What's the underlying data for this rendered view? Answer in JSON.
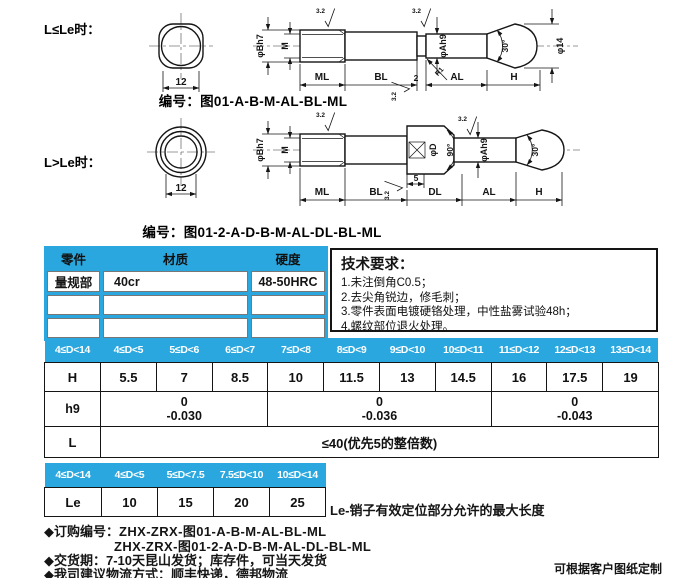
{
  "theme": {
    "accent": "#2aa7de",
    "ink": "#151515"
  },
  "drawing1": {
    "condition": "L≤Le时：",
    "code_label": "编号：图01-A-B-M-AL-BL-ML",
    "dim_12": "12",
    "roughness": "3.2",
    "dia_b": "φBh7",
    "thread": "M",
    "dim_ml": "ML",
    "dim_bl": "BL",
    "dim_2": "2",
    "dim_al": "AL",
    "dim_h": "H",
    "dia_a": "φAh9",
    "angle_30": "30°",
    "dia_14": "φ14",
    "radius_r1": "R1"
  },
  "drawing2": {
    "condition": "L>Le时：",
    "code_label": "编号：图01-2-A-D-B-M-AL-DL-BL-ML",
    "dim_12": "12",
    "roughness": "3.2",
    "dia_b": "φBh7",
    "thread": "M",
    "dia_d": "φD",
    "angle_90": "90°",
    "dim_5": "5",
    "dim_ml": "ML",
    "dim_bl": "BL",
    "dim_dl": "DL",
    "dim_al": "AL",
    "dim_h": "H",
    "dia_a": "φAh9",
    "angle_30": "30°"
  },
  "parts_table": {
    "headers": [
      "零件",
      "材质",
      "硬度"
    ],
    "rows": [
      [
        "量规部",
        "40cr",
        "48-50HRC"
      ],
      [
        "",
        "",
        ""
      ],
      [
        "",
        "",
        ""
      ]
    ]
  },
  "tech_requirements": {
    "title": "技术要求：",
    "items": [
      "1.未注倒角C0.5；",
      "2.去尖角锐边，修毛刺；",
      "3.零件表面电镀硬铬处理，中性盐雾试验48h；",
      "4.螺纹部位退火处理。"
    ]
  },
  "main_table": {
    "corner": "4≤D<14",
    "ranges": [
      "4≤D<5",
      "5≤D<6",
      "6≤D<7",
      "7≤D<8",
      "8≤D<9",
      "9≤D<10",
      "10≤D<11",
      "11≤D<12",
      "12≤D<13",
      "13≤D<14"
    ],
    "h_label": "H",
    "h_values": [
      "5.5",
      "7",
      "8.5",
      "10",
      "11.5",
      "13",
      "14.5",
      "16",
      "17.5",
      "19"
    ],
    "h9_label": "h9",
    "h9_tolerances": [
      {
        "upper": "0",
        "lower": "-0.030",
        "span": 3
      },
      {
        "upper": "0",
        "lower": "-0.036",
        "span": 4
      },
      {
        "upper": "0",
        "lower": "-0.043",
        "span": 3
      }
    ],
    "l_label": "L",
    "l_value": "≤40(优先5的整倍数)"
  },
  "le_table": {
    "corner": "4≤D<14",
    "ranges": [
      "4≤D<5",
      "5≤D<7.5",
      "7.5≤D<10",
      "10≤D<14"
    ],
    "le_label": "Le",
    "le_values": [
      "10",
      "15",
      "20",
      "25"
    ],
    "note": "Le-销子有效定位部分允许的最大长度"
  },
  "footer": {
    "order_label": "◆订购编号：",
    "order_code_1": "ZHX-ZRX-图01-A-B-M-AL-BL-ML",
    "order_code_2": "ZHX-ZRX-图01-2-A-D-B-M-AL-DL-BL-ML",
    "delivery": "◆交货期：7-10天昆山发货；库存件，可当天发货",
    "logistics": "◆我司建议物流方式：顺丰快递，德邦物流",
    "custom_note": "可根据客户图纸定制"
  }
}
